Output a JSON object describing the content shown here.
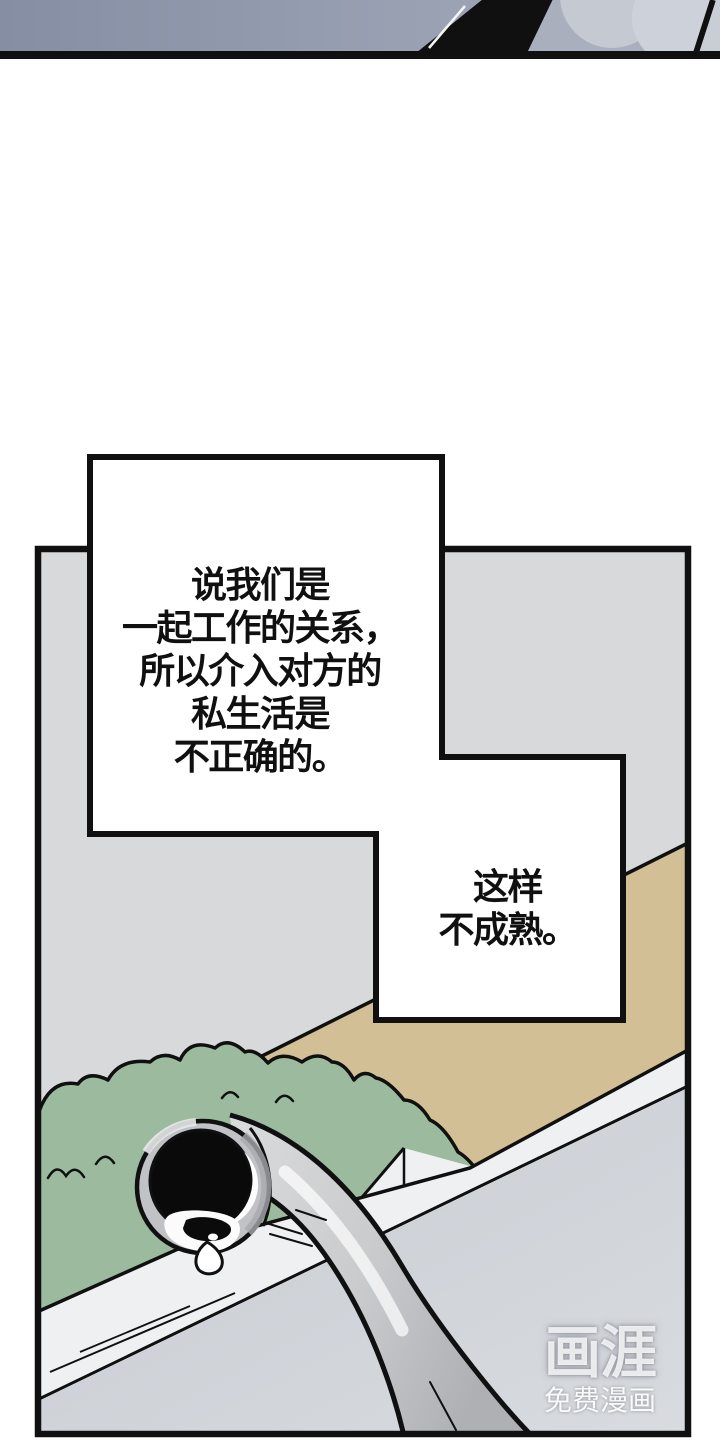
{
  "bubbles": [
    {
      "name": "speech-bubble-1",
      "lines": [
        "说我们是",
        "一起工作的关系，",
        "所以介入对方的",
        "私生活是",
        "不正确的。"
      ]
    },
    {
      "name": "speech-bubble-2",
      "lines": [
        "这样",
        "不成熟。"
      ]
    }
  ],
  "watermark": {
    "logo": "画涯",
    "subtitle": "免费漫画"
  },
  "colors": {
    "page-bg": "#ffffff",
    "ink": "#101010",
    "wall-gray": "#d8d9da",
    "path-tan": "#d3bf95",
    "bush-green": "#9cbb9e",
    "floor-gray": "#c7cbd2",
    "floor-gray-light": "#d8dbdf",
    "curb-white": "#eef0f2",
    "sky-blue-gray": "#858ea3",
    "sky-blue-light": "#a9afbd",
    "cloud-gray": "#c5c9d2",
    "cloud-gray-2": "#cdd2da",
    "pipe-rim": "#c0c2c5",
    "pipe-light": "#dadbdd",
    "pipe-shadow": "#a7a9ad",
    "bubble-white": "#ffffff"
  }
}
